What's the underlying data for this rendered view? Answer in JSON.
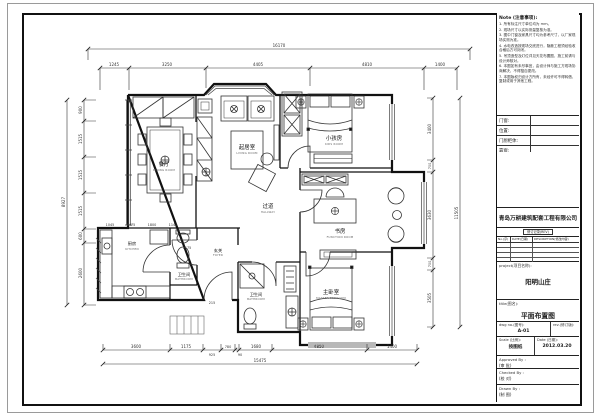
{
  "titleblock": {
    "notes": {
      "heading": "Note (注意事项):",
      "items": [
        "1. 所有标注尺寸单位均为 mm。",
        "2. 现场尺寸以实际测量复核为准。",
        "3. 图中门窗及家具尺寸均为参考尺寸，以厂家现场实测为准。",
        "4. 水电改造按现场交底进行，隐蔽工程须经验收合格后方可封闭。",
        "5. 吊顶造型及灯位详见天花布置图，施工前请与设计师核对。",
        "6. 本图如有未尽事宜，由设计师与施工方现场协商解决，不得擅自更改。",
        "7. 本图版权归设计方所有，未经许可不得转借、复制或用于其他工程。"
      ]
    },
    "fields": [
      {
        "label": "门窗:"
      },
      {
        "label": "位置:"
      },
      {
        "label": "门厨柜体:"
      },
      {
        "label": "靠窗:"
      }
    ],
    "company": "青岛万耕建筑配套工程有限公司",
    "rev_strip": "修订记录(REV)",
    "rev_cols": [
      "No.(序)",
      "DATE(日期)",
      "DESCRIPTION(修改内容)"
    ],
    "project_label": "project(项目名称):",
    "project_value": "阳明山庄",
    "title_label": "title(图名):",
    "title_value": "平面布置图",
    "dwgno_label": "dwg no.(图号):",
    "dwgno_value": "A-01",
    "rev_label": "rev.(修订版):",
    "scale_label": "Scale (比例):",
    "scale_value": "按图纸",
    "date_label": "Date (日期):",
    "date_value": "2012.03.20",
    "approved_label": "Approved By :",
    "approved_value": "(审 批)",
    "checked_label": "Checked By :",
    "checked_value": "(校 对)",
    "drawn_label": "Drawn By :",
    "drawn_value": "(制 图)"
  },
  "plan": {
    "rooms": [
      {
        "cn": "餐厅",
        "en": "DINING ROOM"
      },
      {
        "cn": "起居室",
        "en": "LIVING ROOM"
      },
      {
        "cn": "小孩房",
        "en": "KIDS ROOM"
      },
      {
        "cn": "过道",
        "en": "HALLWAY"
      },
      {
        "cn": "书房",
        "en": "FUNCTION ROOM"
      },
      {
        "cn": "厨房",
        "en": "KITCHEN"
      },
      {
        "cn": "卫生间",
        "en": "BATHROOM"
      },
      {
        "cn": "玄关",
        "en": "FOYER"
      },
      {
        "cn": "卫生间",
        "en": "BATHROOM"
      },
      {
        "cn": "主卧室",
        "en": "MASTER BEDROOM"
      }
    ],
    "dims": {
      "top_total": "16170",
      "top": [
        "1245",
        "3250",
        "4405",
        "4810",
        "1400"
      ],
      "left_total": "8927",
      "left": [
        "900",
        "1515",
        "1515",
        "1515",
        "600",
        "2600"
      ],
      "right_total": "11505",
      "right": [
        "3400",
        "700",
        "3630",
        "700",
        "3505"
      ],
      "bottom_total": "15475",
      "bottom": [
        "3600",
        "1175",
        "925",
        "780",
        "90",
        "1680",
        "4850",
        "1400"
      ],
      "inner": [
        "1045",
        "1475",
        "1800",
        "1140",
        "1175",
        "215"
      ]
    }
  }
}
